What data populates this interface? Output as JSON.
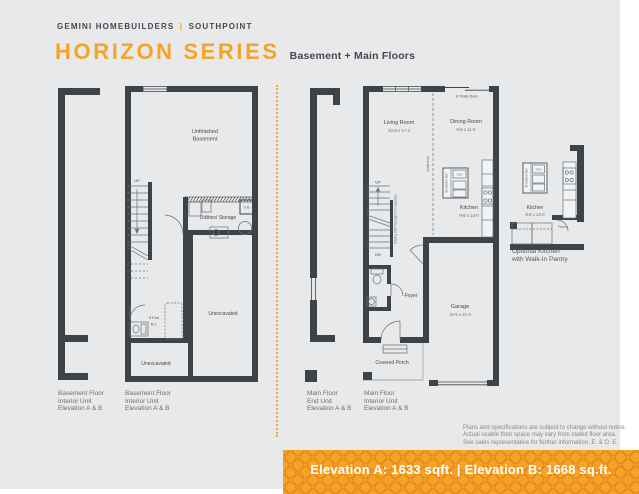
{
  "header": {
    "brand": "GEMINI HOMEBUILDERS",
    "divider": "|",
    "community": "SOUTHPOINT",
    "title": "HORIZON SERIES",
    "subtitle": "Basement + Main Floors"
  },
  "colors": {
    "accent": "#F5A428",
    "ink": "#3E4347",
    "page_bg": "#E8E9EA",
    "banner_bg": "#F5A227"
  },
  "basement": {
    "room_line1": "Unfinished",
    "room_line2": "Basement",
    "up": "UP",
    "tub": "TUB",
    "utilities": "Utilities/ Storage",
    "bath_line1": "3 Pce",
    "bath_line2": "R.I.",
    "unexcavated_right": "Unexcavated",
    "unexcavated_bottom": "Unexcavated"
  },
  "main": {
    "living_name": "Living Room",
    "living_dims": "10-8 x 17-3",
    "dining_name": "Dining Room",
    "dining_dims": "9-8 x 11-9",
    "kitchen_name": "Kitchen",
    "kitchen_dims": "9-8 x 12-0",
    "garage_name": "Garage",
    "garage_dims": "10-5 x 21-0",
    "foyer": "Foyer",
    "covered_porch": "Covered Porch",
    "patio_door": "6' Patio Door",
    "bulkhead": "Bulkhead",
    "railing": "Railing With Wrought Iron Spindles",
    "up": "UP",
    "dn": "DN",
    "dw": "D/W",
    "breakfast_bar": "Breakfast Bar"
  },
  "optional_kitchen": {
    "kitchen_name": "Kitchen",
    "kitchen_dims": "9-8 x 13-0",
    "pantry": "Pantry",
    "dw": "D/W",
    "breakfast_bar": "Breakfast Bar",
    "caption_line1": "Optional Kitchen",
    "caption_line2": "with Walk-In Pantry"
  },
  "plan_labels": [
    {
      "line1": "Basement Floor",
      "line2": "Interior Unit",
      "line3": "Elevation A & B"
    },
    {
      "line1": "Basement Floor",
      "line2": "Interior Unit",
      "line3": "Elevation A & B"
    },
    {
      "line1": "Main Floor",
      "line2": "End Unit",
      "line3": "Elevation A & B"
    },
    {
      "line1": "Main Floor",
      "line2": "Interior Unit",
      "line3": "Elevation A & B"
    }
  ],
  "disclaimer": {
    "line1": "Plans and specifications are subject to change without notice.",
    "line2": "Actual usable floor space may vary from stated floor area.",
    "line3": "See sales representative for further information. E. & O. E."
  },
  "banner": {
    "text": "Elevation A: 1633 sqft. | Elevation B: 1668 sq.ft."
  }
}
